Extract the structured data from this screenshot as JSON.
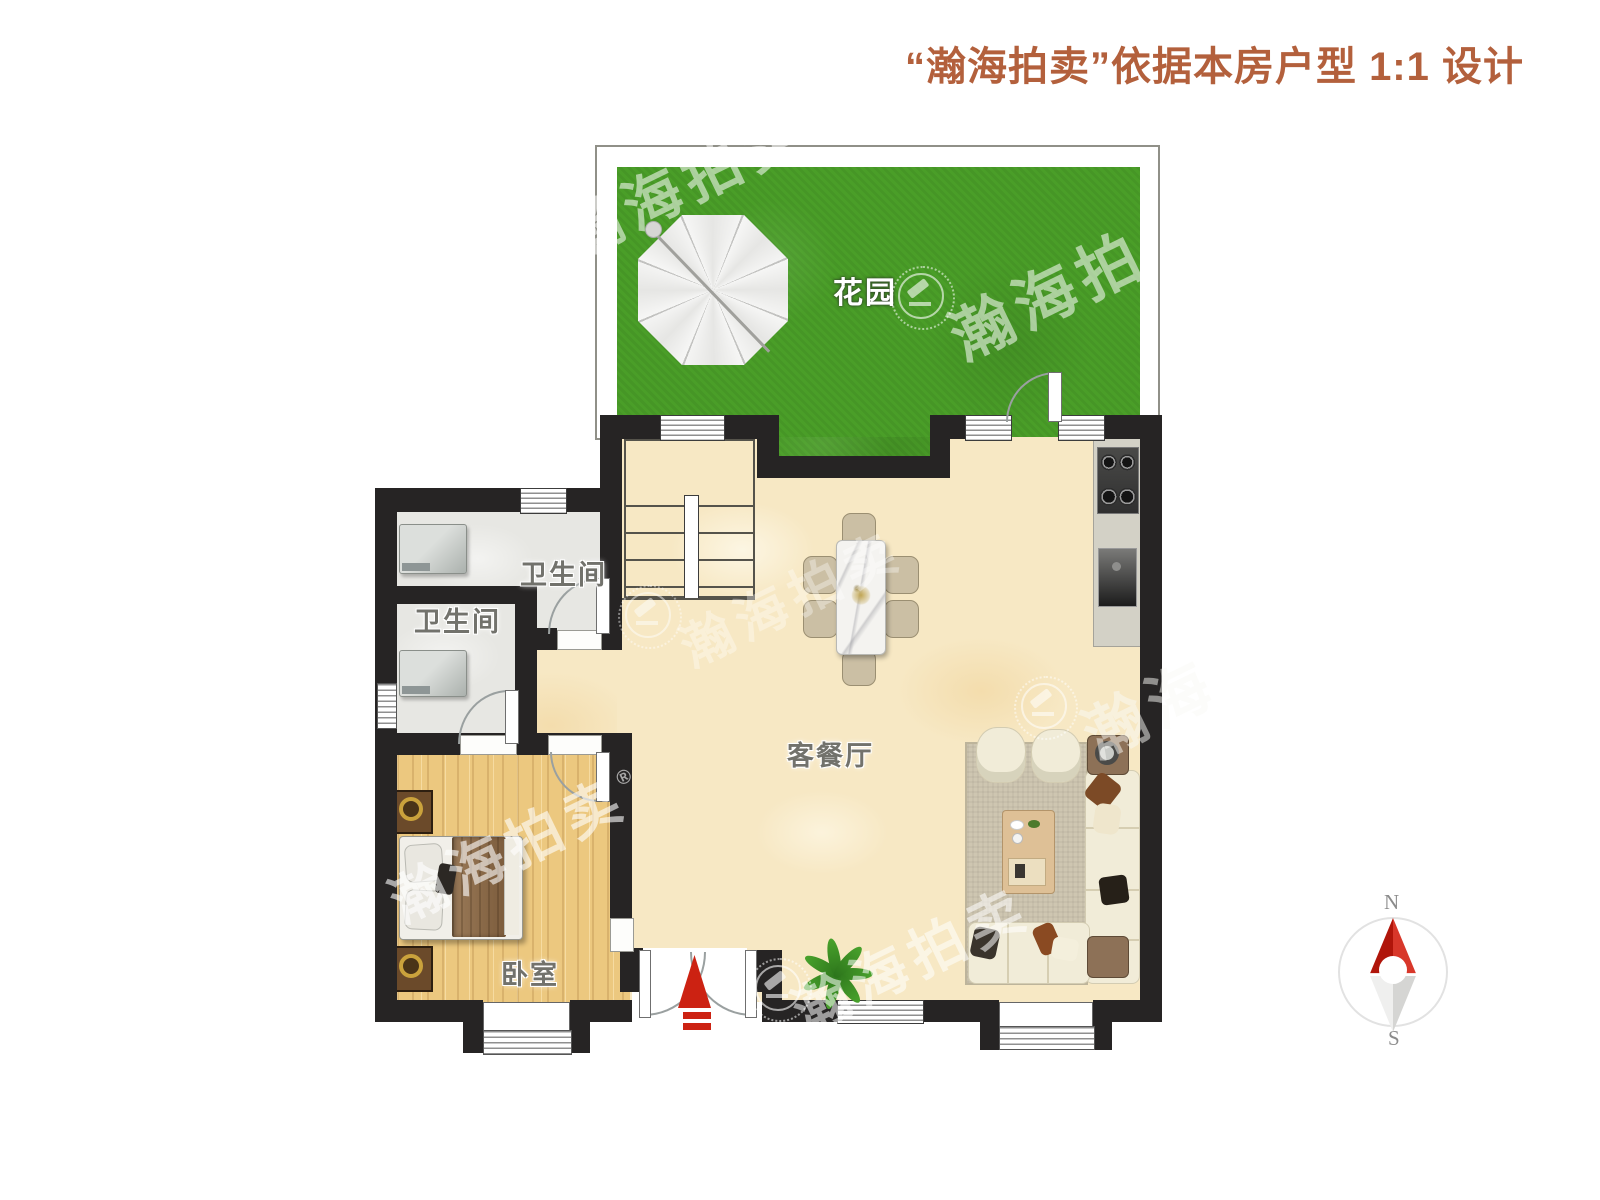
{
  "header": {
    "title": "“瀚海拍卖”依据本房户型 1:1 设计"
  },
  "rooms": {
    "garden": "花园",
    "bath_upper": "卫生间",
    "bath_lower": "卫生间",
    "living_dining": "客餐厅",
    "bedroom": "卧室"
  },
  "watermark": {
    "brand": "瀚海拍卖",
    "brand_short": "瀚海拍",
    "brand_min": "瀚海",
    "registered": "®"
  },
  "compass": {
    "north": "N",
    "south": "S"
  },
  "colors": {
    "header_text": "#b3603c",
    "wall": "#262424",
    "grass": "#4a9e28",
    "floor": "#f7e8c4",
    "wood_floor": "#ecc87f",
    "bath_floor": "#e7e7e3",
    "entry_arrow_red": "#cc2212",
    "compass_north_red": "#b0150a"
  }
}
